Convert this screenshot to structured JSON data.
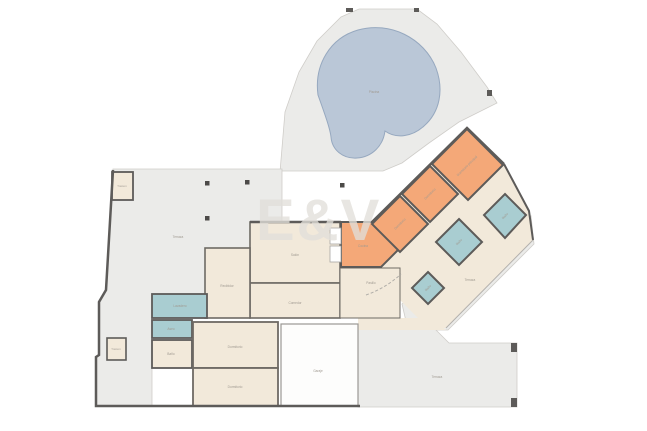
{
  "watermark": "E&V",
  "plan": {
    "labels": {
      "pool": "Piscina",
      "terrace_left": "Terraza",
      "terrace_right": "Terraza",
      "terrace_bottom": "Terraza",
      "living": "Salón",
      "dining": "Comedor",
      "hall": "Recibidor",
      "corridor": "Pasillo",
      "kitchen": "Cocina",
      "master": "Dormitorio principal",
      "bedroom2": "Dormitorio",
      "bedroom3": "Dormitorio",
      "bedroom4": "Dormitorio",
      "bedroom5": "Dormitorio",
      "bath1": "Baño",
      "bath2": "Baño",
      "bath3": "Baño",
      "bath4": "Baño",
      "laundry": "Lavadero",
      "toilet": "Aseo",
      "garage": "Garaje",
      "storage1": "Trastero",
      "storage2": "Trastero"
    },
    "colors": {
      "pool": "#bac7d7",
      "pool_border": "#96a8bf",
      "terrace": "#ebebe9",
      "terrace_border": "#cfcdc9",
      "room": "#f2e9da",
      "bedroom": "#f4a878",
      "bath": "#a9cdd1",
      "wall": "#5d5b59"
    }
  }
}
